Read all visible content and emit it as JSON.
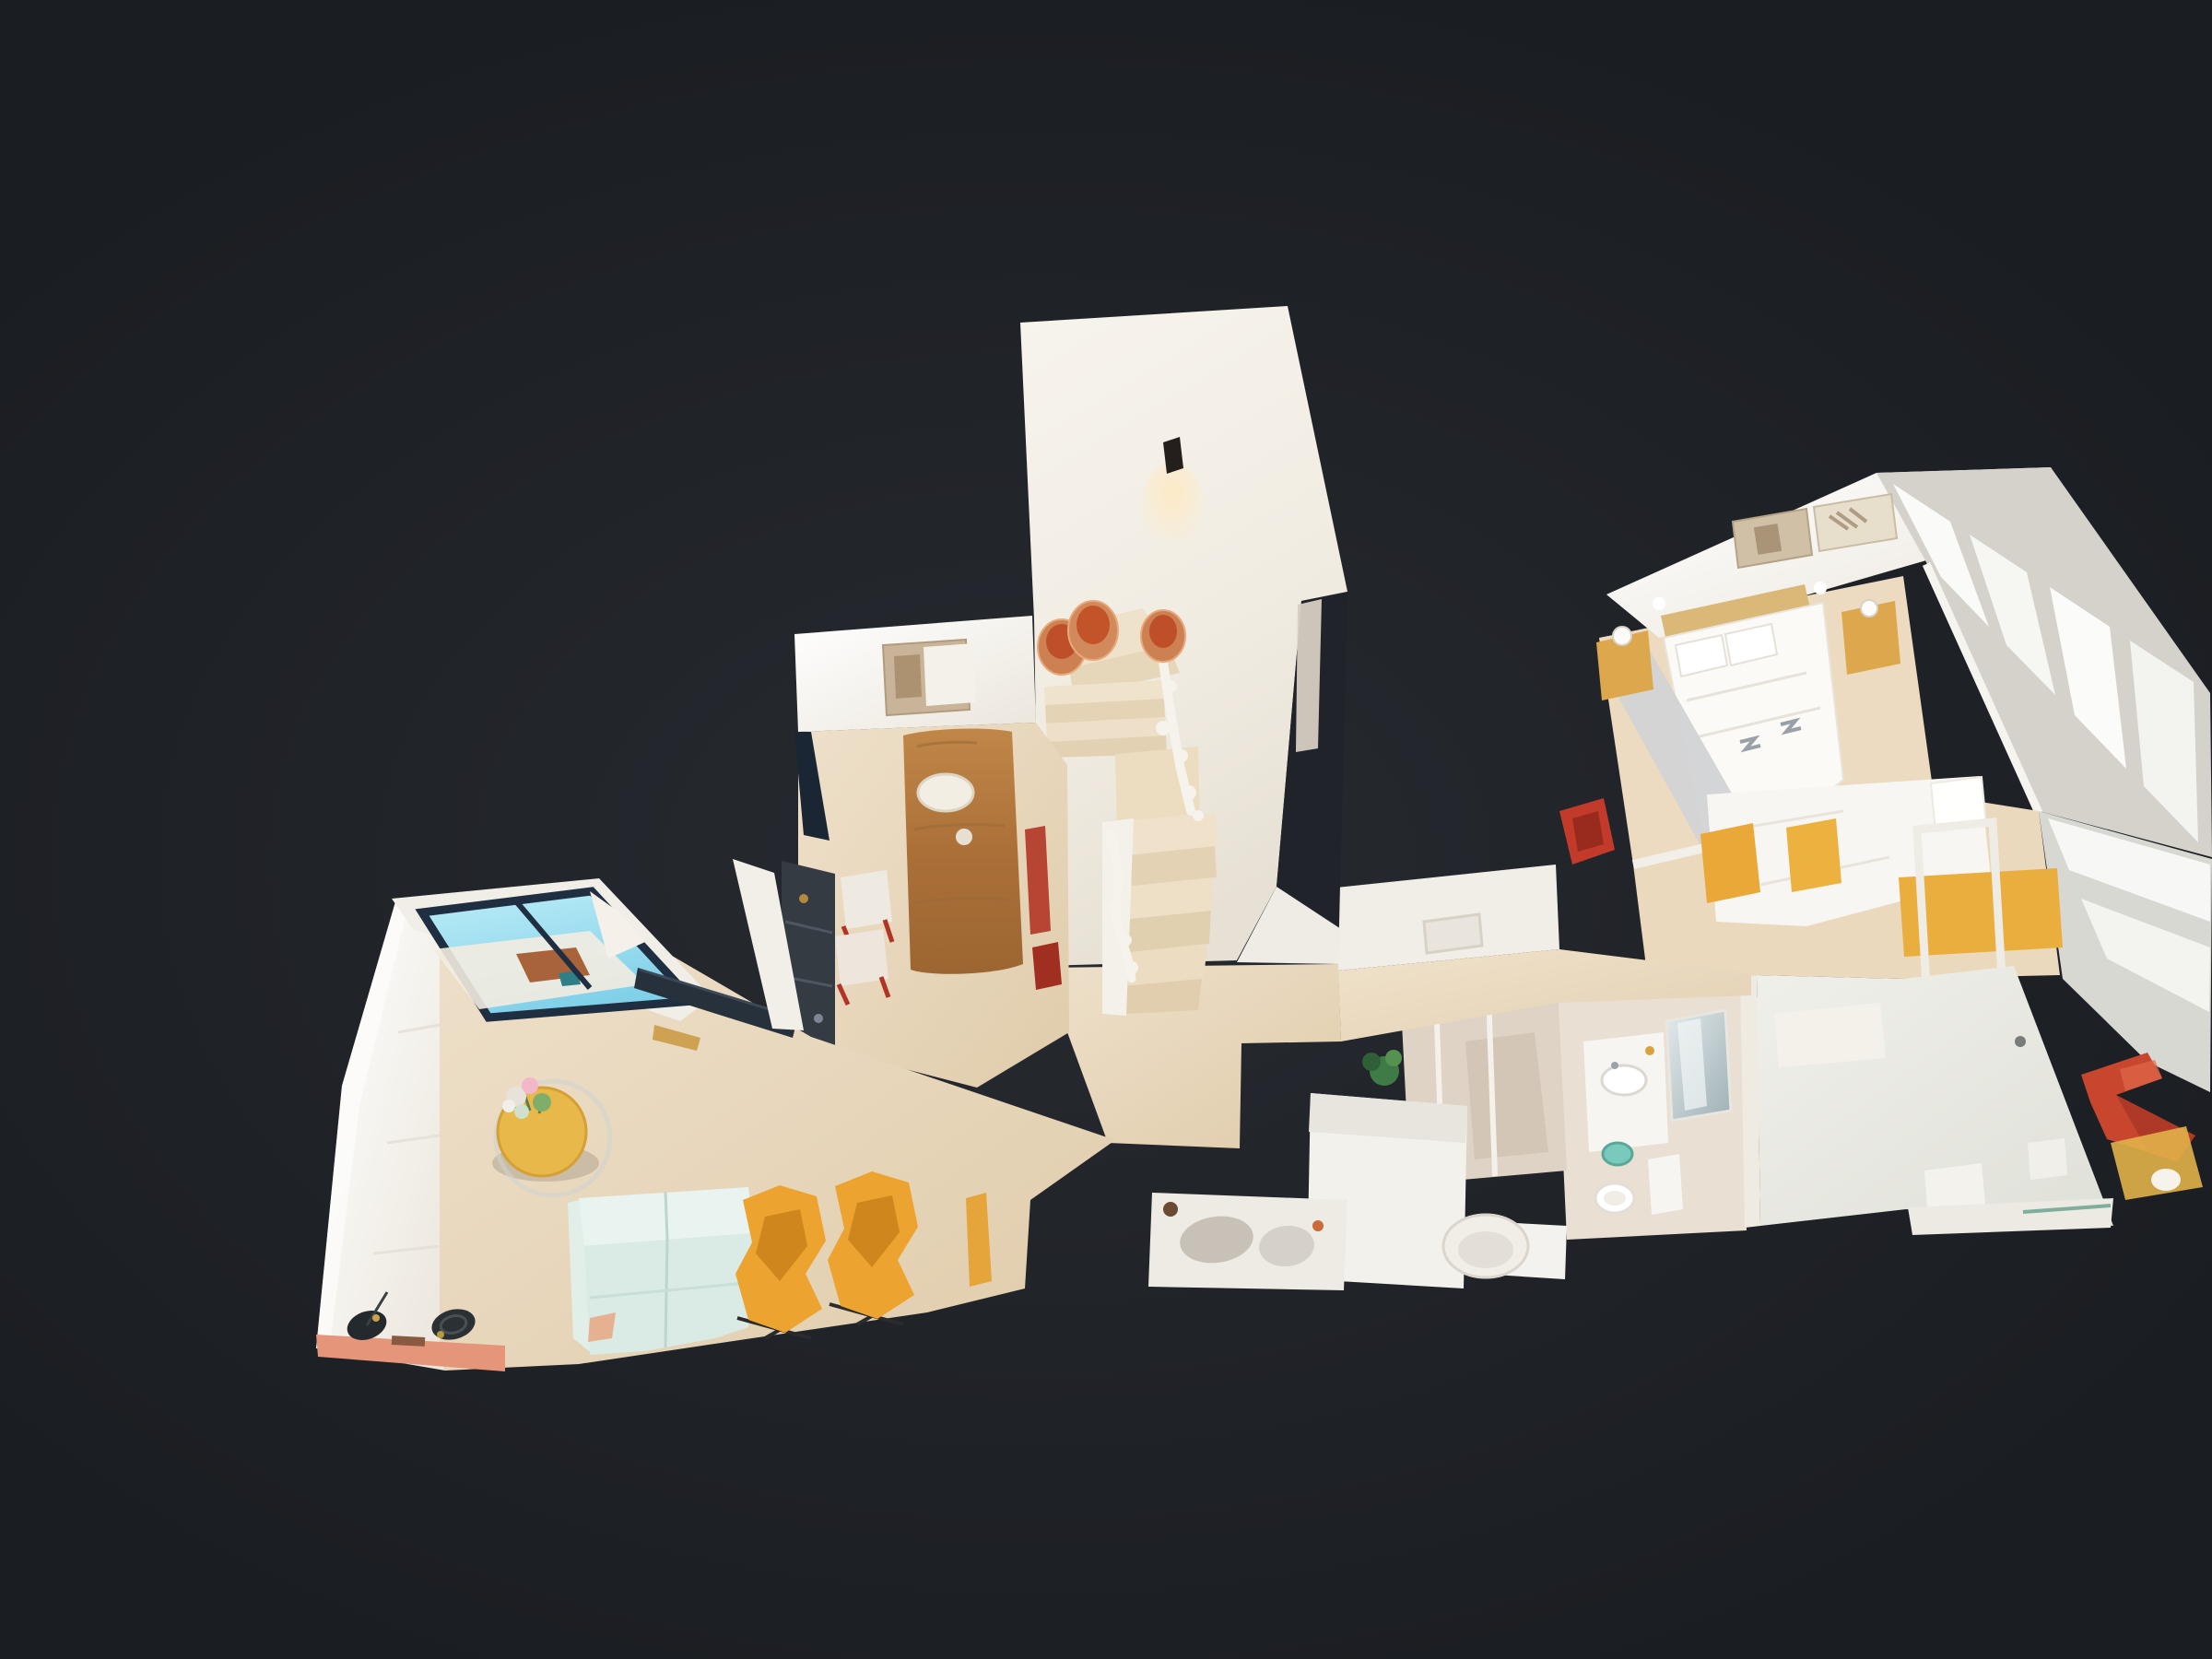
{
  "scene": {
    "type": "3d-dollhouse-view",
    "description": "Top-down dollhouse view of a scanned duplex apartment floating on a dark background, Matterport-style 3D tour viewport with no visible UI chrome",
    "background_color": "#1d2024",
    "vignette_color": "#272b31",
    "wall_color": "#f4f0e9",
    "floor_color": "#e8d9c0"
  },
  "rooms": [
    {
      "name": "living-room",
      "items": [
        {
          "name": "curtain-wall",
          "color": "#fbfaf7"
        },
        {
          "name": "terrace-window",
          "sky_color": "#8fd4ea",
          "frame_color": "#1f2e40"
        },
        {
          "name": "tv-console",
          "color": "#27313c"
        },
        {
          "name": "sofa",
          "color": "#dcebe4"
        },
        {
          "name": "armchair-left",
          "color": "#eda32f"
        },
        {
          "name": "armchair-right",
          "color": "#eda32f"
        },
        {
          "name": "coffee-table",
          "color": "#e9b84b"
        },
        {
          "name": "flower-bouquet",
          "colors": [
            "#f2b7c8",
            "#7fae6b",
            "#f0efe9"
          ]
        },
        {
          "name": "floor-lamps",
          "color": "#24292d"
        },
        {
          "name": "console-shelf",
          "color": "#e59579"
        }
      ]
    },
    {
      "name": "dining-room",
      "items": [
        {
          "name": "live-edge-table",
          "color": "#b5793f"
        },
        {
          "name": "wall-art",
          "color": "#c9b499"
        },
        {
          "name": "media-shelf",
          "color": "#343b43"
        },
        {
          "name": "dining-chairs",
          "accent_color": "#b13526"
        }
      ]
    },
    {
      "name": "staircase",
      "items": [
        {
          "name": "stair-tower-wall",
          "color": "#f4f1ea"
        },
        {
          "name": "wall-sconce",
          "color": "#241f1c",
          "glow_color": "#ffe9bf"
        },
        {
          "name": "terracotta-pots",
          "color": "#cd8052",
          "inner_color": "#bf4f28"
        },
        {
          "name": "stair-treads",
          "color": "#ead9bf"
        },
        {
          "name": "white-railing",
          "color": "#f6f3ec"
        }
      ]
    },
    {
      "name": "hallway",
      "items": [
        {
          "name": "cut-wall-band",
          "color": "#f1eee7"
        },
        {
          "name": "white-sideboard",
          "color": "#f3f1ec"
        },
        {
          "name": "plant",
          "color": "#3f7b46"
        },
        {
          "name": "credenza-with-cushions",
          "color": "#eeebe4"
        },
        {
          "name": "tub-chair",
          "color": "#f1eee8"
        }
      ]
    },
    {
      "name": "bathroom",
      "items": [
        {
          "name": "shower-glass",
          "color": "#ded3c5"
        },
        {
          "name": "vanity",
          "color": "#f7f5f1"
        },
        {
          "name": "mirror",
          "color": "#aebfc4"
        },
        {
          "name": "toilet",
          "color": "#ffffff"
        },
        {
          "name": "laundry-basket",
          "color": "#79cabc"
        }
      ]
    },
    {
      "name": "master-bedroom",
      "items": [
        {
          "name": "double-bed",
          "color": "#fbfaf6"
        },
        {
          "name": "headboard",
          "color": "#d9b878"
        },
        {
          "name": "nightstands",
          "color": "#dda74e"
        },
        {
          "name": "wall-art-frames",
          "color": "#cfc0a6"
        },
        {
          "name": "window-blinds",
          "color": "#fafaf8"
        },
        {
          "name": "accent-chair",
          "color": "#c23b2a"
        }
      ]
    },
    {
      "name": "second-bedroom",
      "items": [
        {
          "name": "bed-duvet",
          "color": "#f8f6f2"
        },
        {
          "name": "yellow-headboard",
          "color": "#e9ae3e"
        },
        {
          "name": "desk-frame",
          "color": "#efece5"
        },
        {
          "name": "mirror-panels",
          "color": "#ccd5d4"
        },
        {
          "name": "z-chair",
          "color": "#c8452e"
        },
        {
          "name": "window-blinds",
          "color": "#f7f7f5"
        }
      ]
    }
  ]
}
